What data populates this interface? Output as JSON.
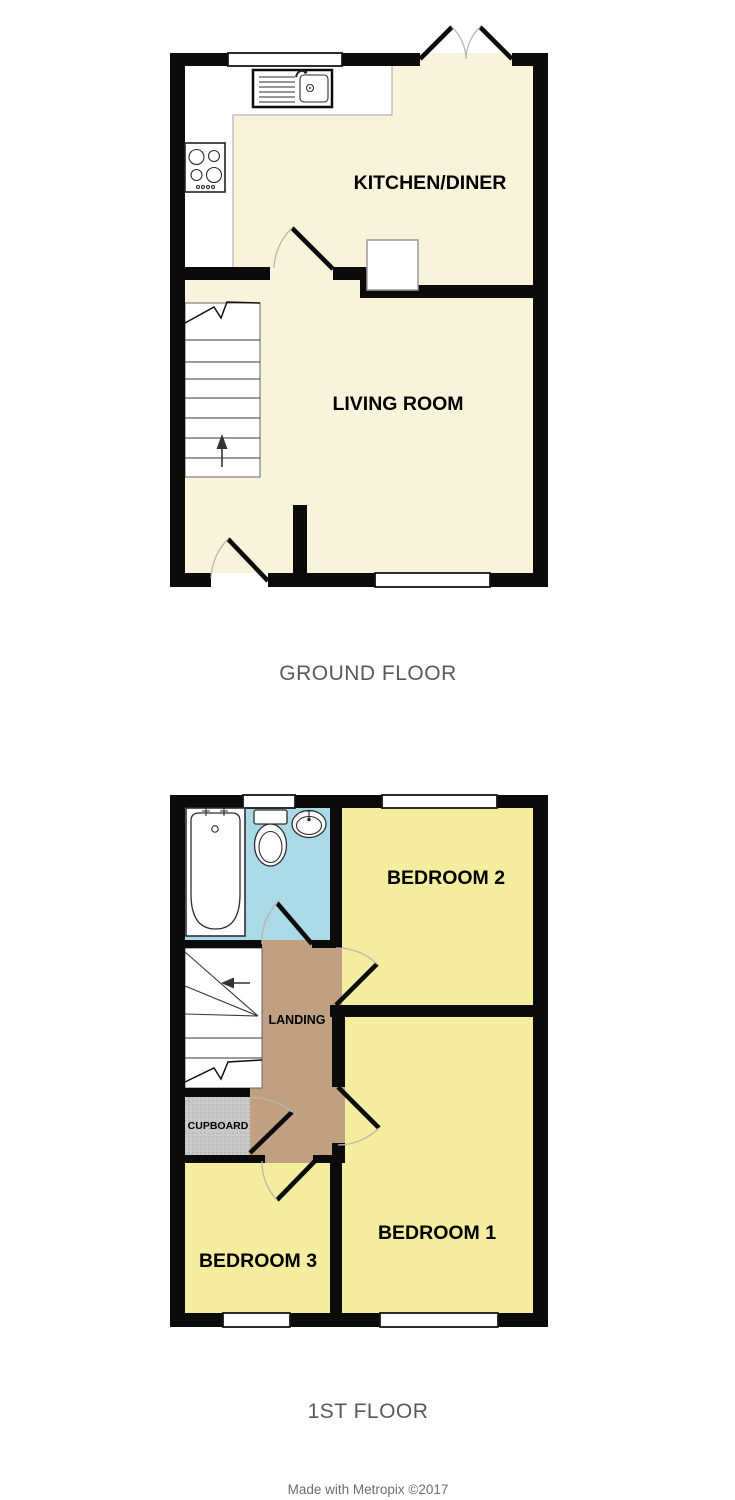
{
  "colors": {
    "wall": "#0b0b0b",
    "room_cream": "#faf3db",
    "room_yellow": "#f4ed9e",
    "room_blue": "#abdae7",
    "room_tan": "#c0a081",
    "cupboard_gray": "#c9c9c9",
    "counter_edge": "#b5b5b5",
    "door_arc": "#b8b8ac",
    "stair_outline": "#666666",
    "room_label": "#000000",
    "floor_title": "#5a5a5a",
    "credit": "#6e6e6e"
  },
  "ground_floor": {
    "title": "GROUND FLOOR",
    "kitchen_label": "KITCHEN/DINER",
    "living_label": "LIVING ROOM"
  },
  "first_floor": {
    "title": "1ST FLOOR",
    "bedroom1_label": "BEDROOM 1",
    "bedroom2_label": "BEDROOM 2",
    "bedroom3_label": "BEDROOM 3",
    "landing_label": "LANDING",
    "cupboard_label": "CUPBOARD"
  },
  "footer": {
    "credit": "Made with Metropix ©2017"
  }
}
